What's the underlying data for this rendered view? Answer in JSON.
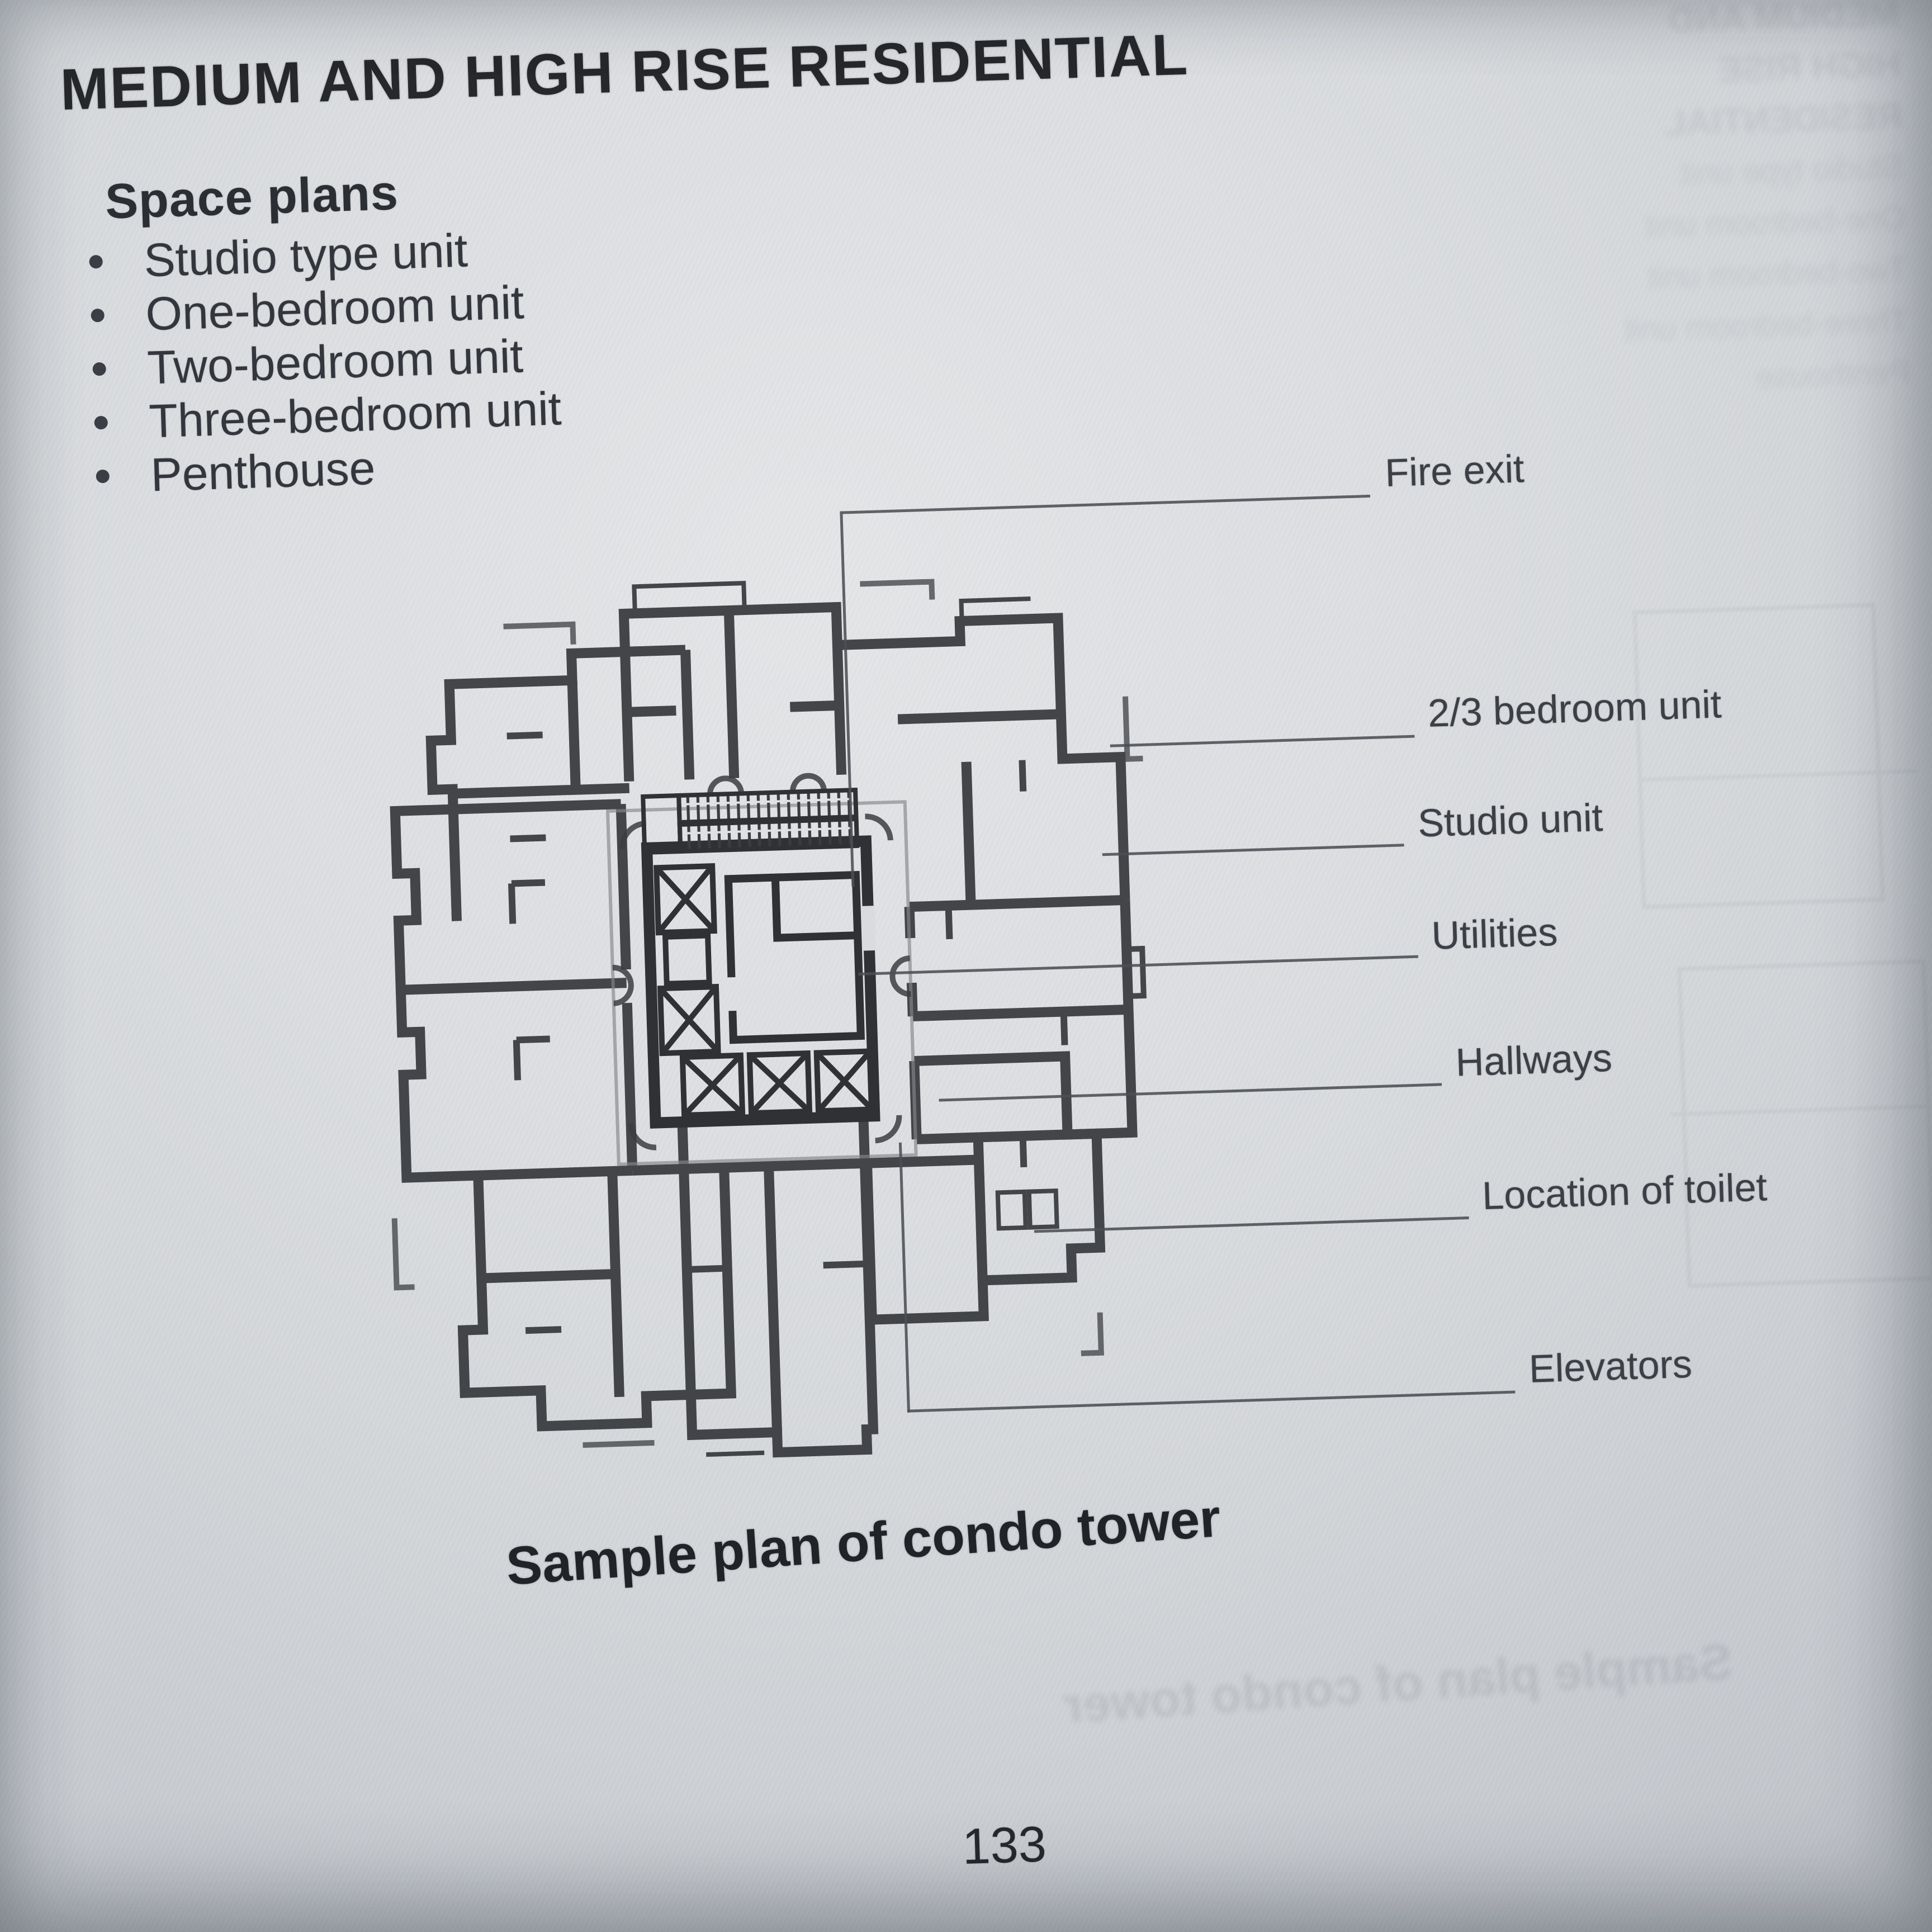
{
  "page": {
    "title": "MEDIUM AND HIGH RISE RESIDENTIAL",
    "caption": "Sample plan of condo tower",
    "page_number": "133"
  },
  "space_plans": {
    "heading": "Space plans",
    "items": [
      "Studio type unit",
      "One-bedroom unit",
      "Two-bedroom unit",
      "Three-bedroom unit",
      "Penthouse"
    ]
  },
  "plan": {
    "description": "floor-plan-of-condo-tower",
    "labels": [
      {
        "text": "Fire exit"
      },
      {
        "text": "2/3 bedroom unit"
      },
      {
        "text": "Studio unit"
      },
      {
        "text": "Utilities"
      },
      {
        "text": "Hallways"
      },
      {
        "text": "Location of toilet"
      },
      {
        "text": "Elevators"
      }
    ],
    "colors": {
      "ink": "#35373c",
      "core_ink": "#2f3135",
      "paper": "#d9dbde",
      "leader": "#4b4e54"
    }
  }
}
